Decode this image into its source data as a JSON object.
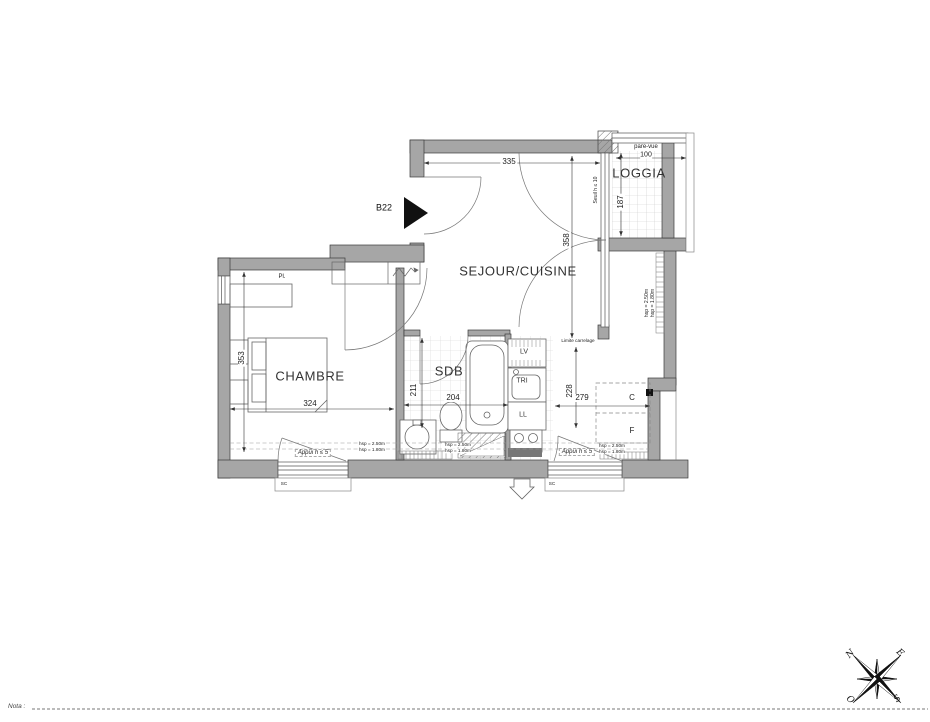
{
  "plan": {
    "unit": "B22",
    "rooms": {
      "sejour": "SEJOUR/CUISINE",
      "chambre": "CHAMBRE",
      "sdb": "SDB",
      "loggia": "LOGGIA",
      "placard": "Pl."
    },
    "dims": {
      "d335": "335",
      "d358": "358",
      "d187": "187",
      "d100": "100",
      "d324": "324",
      "d353": "353",
      "d211": "211",
      "d204": "204",
      "d228": "228",
      "d279": "279"
    },
    "notes": {
      "pare_vue": "pare-vue",
      "seuil": "Seuil h ≤ 10",
      "appui": "Appui h ≤ 5",
      "limite": "Limite carrelage",
      "hsp_high": "hsp = 2.50m",
      "hsp_low": "hsp = 1.80m",
      "coffre": "SC"
    },
    "appliances": {
      "lv": "LV",
      "tri": "TRI",
      "ll": "LL",
      "c": "C",
      "f": "F"
    },
    "compass": {
      "n": "N",
      "e": "E",
      "s": "S",
      "o": "O"
    },
    "nota_label": "Nota :"
  }
}
